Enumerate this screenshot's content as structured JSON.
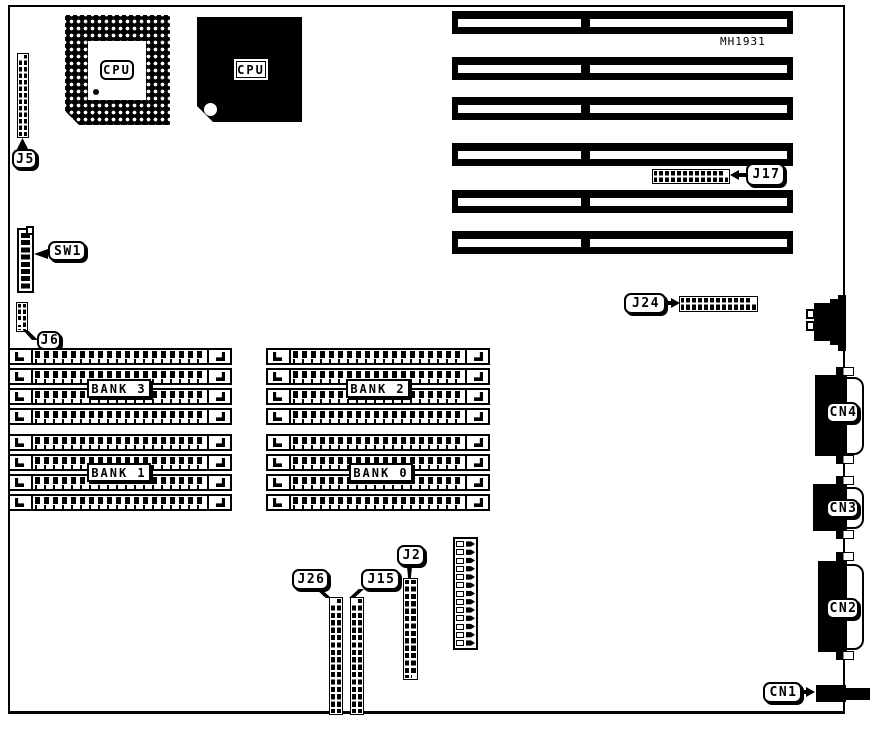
{
  "diagram": {
    "part_number": "MH1931",
    "cpu_socket": {
      "label": "CPU"
    },
    "cpu_chip": {
      "label": "CPU"
    },
    "connector_labels": {
      "j5": "J5",
      "sw1": "SW1",
      "j6": "J6",
      "j17": "J17",
      "j24": "J24",
      "j26": "J26",
      "j15": "J15",
      "j2": "J2",
      "cn1": "CN1",
      "cn2": "CN2",
      "cn3": "CN3",
      "cn4": "CN4"
    },
    "memory_banks": [
      {
        "label": "BANK 3"
      },
      {
        "label": "BANK 2"
      },
      {
        "label": "BANK 1"
      },
      {
        "label": "BANK 0"
      }
    ],
    "expansion_slots": {
      "count": 6
    },
    "colors": {
      "ink": "#000000",
      "background": "#ffffff"
    }
  }
}
